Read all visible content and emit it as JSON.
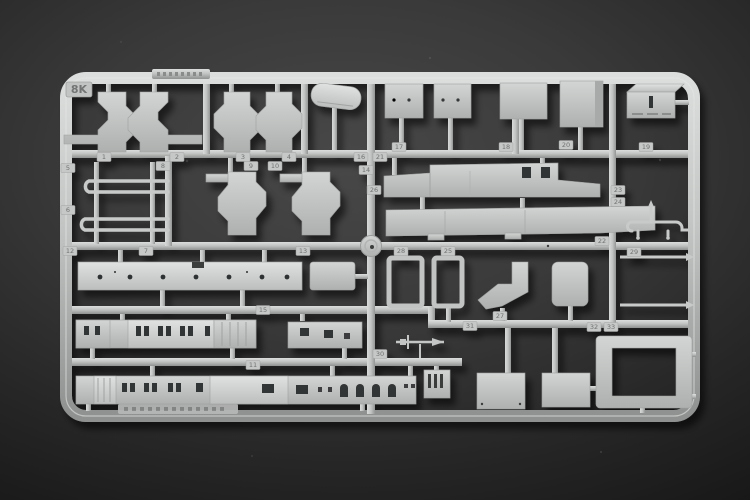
{
  "sprue": {
    "code_label": "8K"
  },
  "colors": {
    "plastic": "#c6c8c7",
    "plastic_highlight": "#dcdedd",
    "plastic_shadow": "#8f9190",
    "background": "#3a3a3a",
    "background_vignette": "#171717",
    "part_hole": "#2f3132",
    "tag_text": "#6f7170"
  },
  "tags": [
    {
      "label": "1"
    },
    {
      "label": "2"
    },
    {
      "label": "3"
    },
    {
      "label": "4"
    },
    {
      "label": "5"
    },
    {
      "label": "6"
    },
    {
      "label": "7"
    },
    {
      "label": "8"
    },
    {
      "label": "9"
    },
    {
      "label": "10"
    },
    {
      "label": "11"
    },
    {
      "label": "12"
    },
    {
      "label": "13"
    },
    {
      "label": "14"
    },
    {
      "label": "15"
    },
    {
      "label": "16"
    },
    {
      "label": "17"
    },
    {
      "label": "18"
    },
    {
      "label": "19"
    },
    {
      "label": "20"
    },
    {
      "label": "21"
    },
    {
      "label": "22"
    },
    {
      "label": "23"
    },
    {
      "label": "24"
    },
    {
      "label": "25"
    },
    {
      "label": "26"
    },
    {
      "label": "27"
    },
    {
      "label": "28"
    },
    {
      "label": "29"
    },
    {
      "label": "30"
    },
    {
      "label": "31"
    },
    {
      "label": "32"
    },
    {
      "label": "33"
    }
  ]
}
